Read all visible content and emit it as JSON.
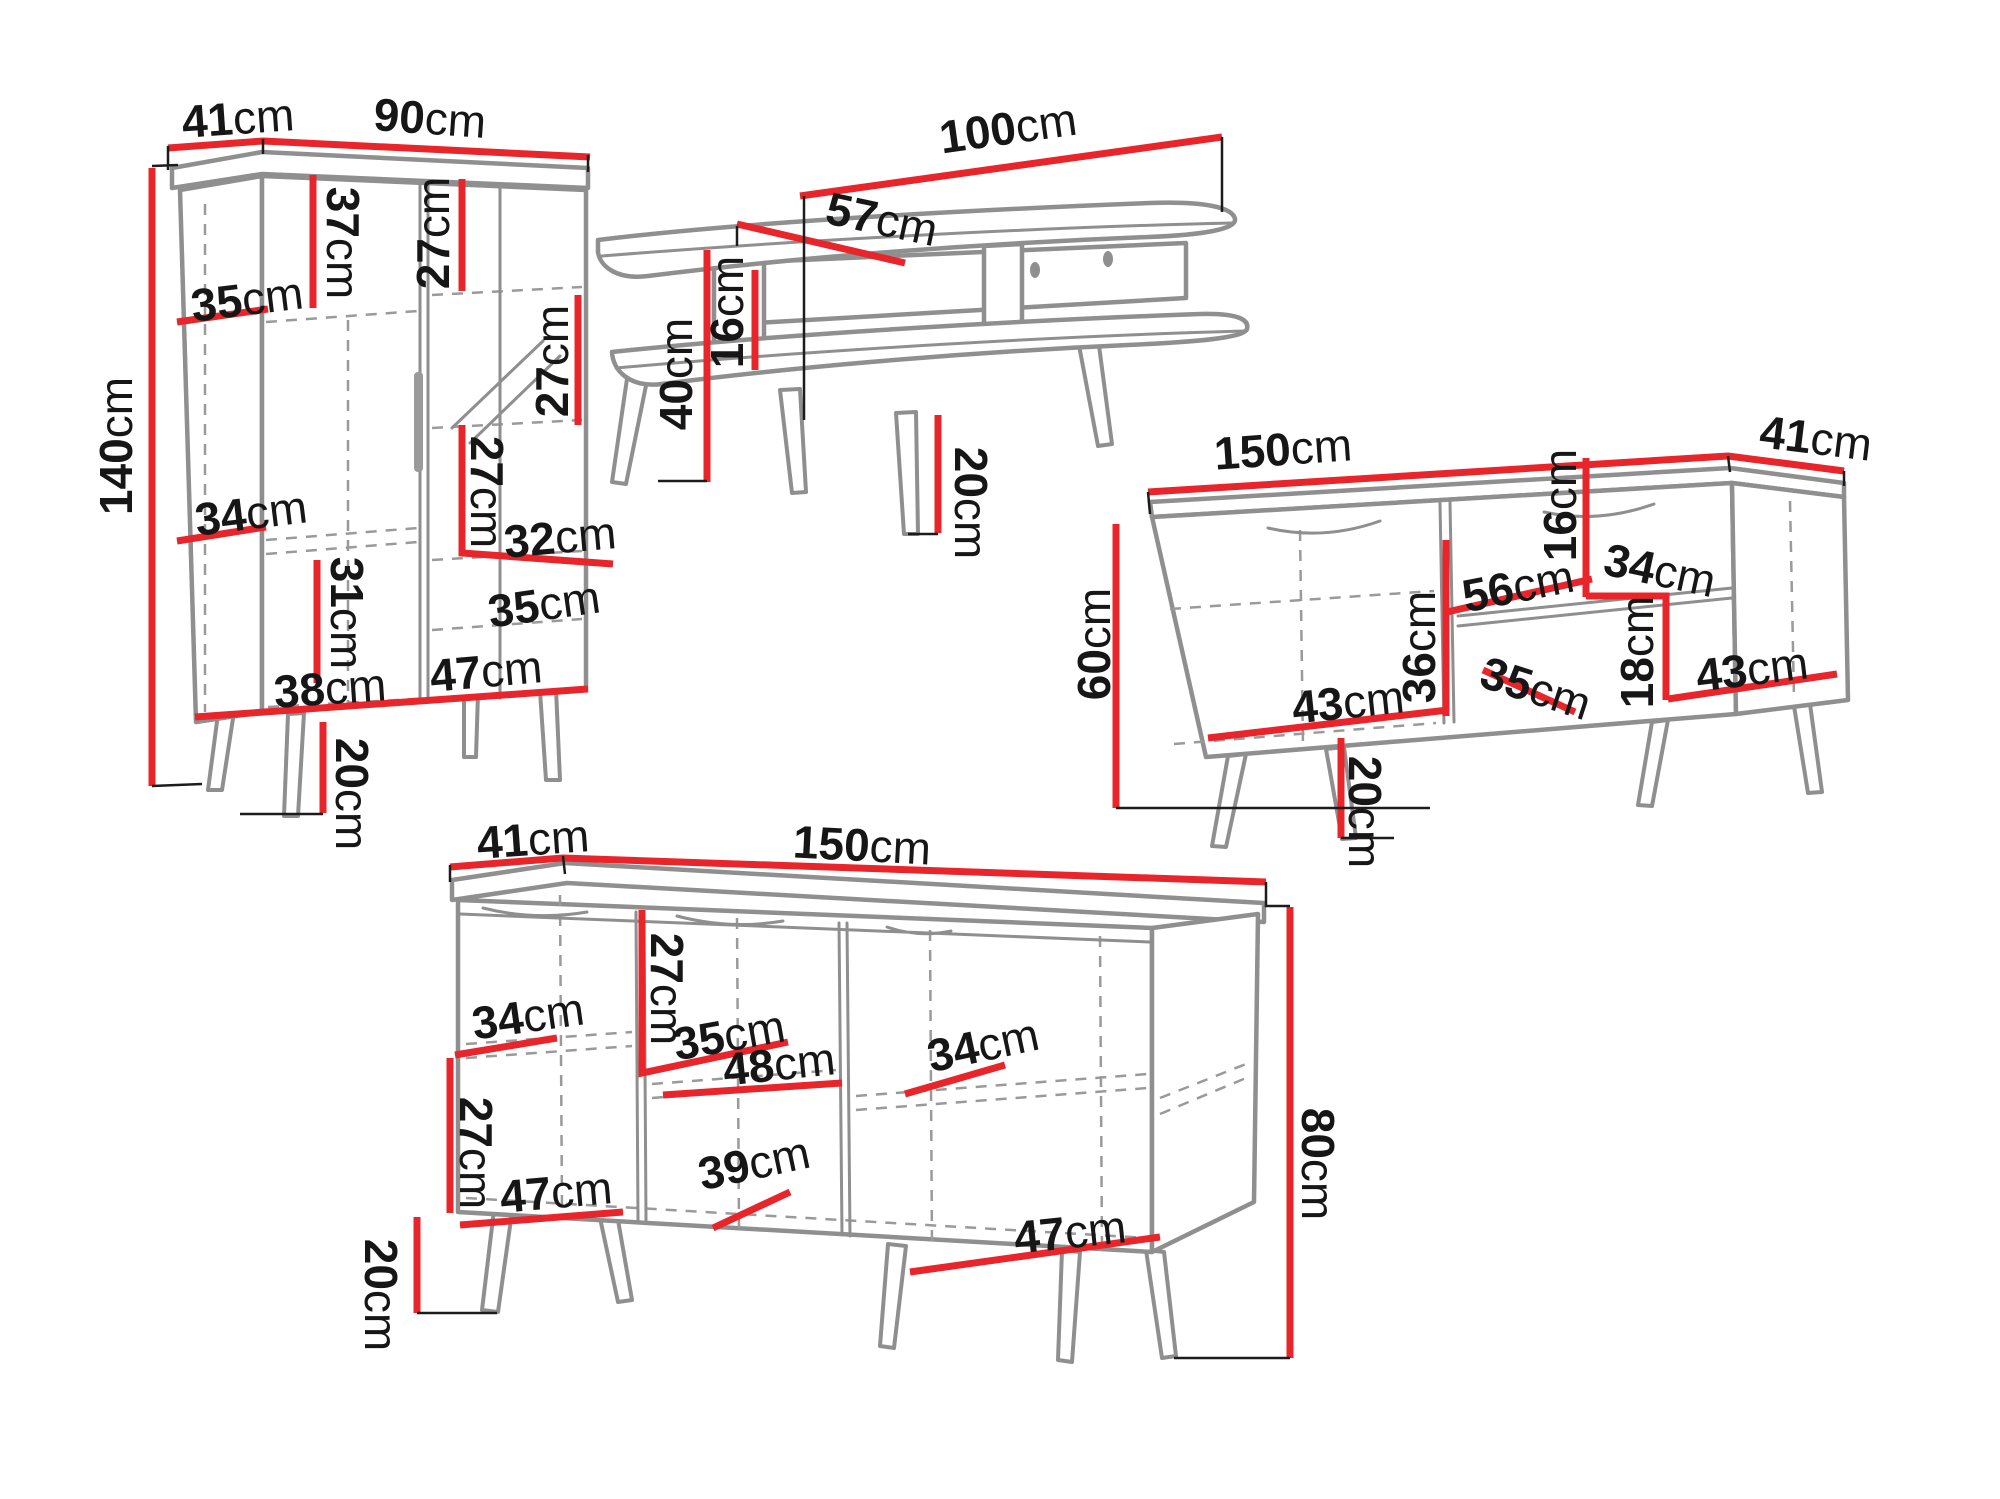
{
  "diagram": {
    "unit": "cm",
    "colors": {
      "dimension_line": "#e8252a",
      "furniture_line": "#8f8f8f",
      "label_text": "#161616",
      "background": "#ffffff"
    },
    "pieces": [
      {
        "id": "wardrobe-cabinet",
        "labels": [
          {
            "id": "top-depth",
            "value": "41"
          },
          {
            "id": "top-width",
            "value": "90"
          },
          {
            "id": "total-height",
            "value": "140"
          },
          {
            "id": "upper-shelf-height",
            "value": "37"
          },
          {
            "id": "upper-right-shelf-height",
            "value": "27"
          },
          {
            "id": "left-shelf-width",
            "value": "35"
          },
          {
            "id": "glass-shelf-height",
            "value": "27"
          },
          {
            "id": "middle-shelf-width",
            "value": "34"
          },
          {
            "id": "middle-right-shelf-height",
            "value": "27"
          },
          {
            "id": "right-shelf-width",
            "value": "32"
          },
          {
            "id": "lower-shelf-height",
            "value": "31"
          },
          {
            "id": "lower-right-shelf-width",
            "value": "35"
          },
          {
            "id": "bottom-left-width",
            "value": "38"
          },
          {
            "id": "bottom-right-width",
            "value": "47"
          },
          {
            "id": "leg-height",
            "value": "20"
          }
        ]
      },
      {
        "id": "coffee-table",
        "labels": [
          {
            "id": "top-length",
            "value": "100"
          },
          {
            "id": "top-depth",
            "value": "57"
          },
          {
            "id": "total-height",
            "value": "40"
          },
          {
            "id": "shelf-gap-height",
            "value": "16"
          },
          {
            "id": "leg-height",
            "value": "20"
          }
        ]
      },
      {
        "id": "tv-stand",
        "labels": [
          {
            "id": "top-width",
            "value": "150"
          },
          {
            "id": "top-depth",
            "value": "41"
          },
          {
            "id": "total-height",
            "value": "60"
          },
          {
            "id": "niche-height",
            "value": "16"
          },
          {
            "id": "niche-width",
            "value": "56"
          },
          {
            "id": "right-shelf-width",
            "value": "34"
          },
          {
            "id": "door-height",
            "value": "36"
          },
          {
            "id": "lower-niche-width",
            "value": "35"
          },
          {
            "id": "lower-niche-height",
            "value": "18"
          },
          {
            "id": "left-door-width",
            "value": "43"
          },
          {
            "id": "right-door-width",
            "value": "43"
          },
          {
            "id": "leg-height",
            "value": "20"
          }
        ]
      },
      {
        "id": "sideboard",
        "labels": [
          {
            "id": "top-depth",
            "value": "41"
          },
          {
            "id": "top-width",
            "value": "150"
          },
          {
            "id": "upper-shelf-height",
            "value": "27"
          },
          {
            "id": "left-shelf-width",
            "value": "34"
          },
          {
            "id": "middle-shelf-width",
            "value": "35"
          },
          {
            "id": "middle-niche-width",
            "value": "48"
          },
          {
            "id": "right-shelf-width",
            "value": "34"
          },
          {
            "id": "lower-shelf-height",
            "value": "27"
          },
          {
            "id": "left-door-width",
            "value": "47"
          },
          {
            "id": "middle-door-width",
            "value": "39"
          },
          {
            "id": "right-door-width",
            "value": "47"
          },
          {
            "id": "leg-height",
            "value": "20"
          },
          {
            "id": "body-height",
            "value": "80"
          }
        ]
      }
    ]
  }
}
